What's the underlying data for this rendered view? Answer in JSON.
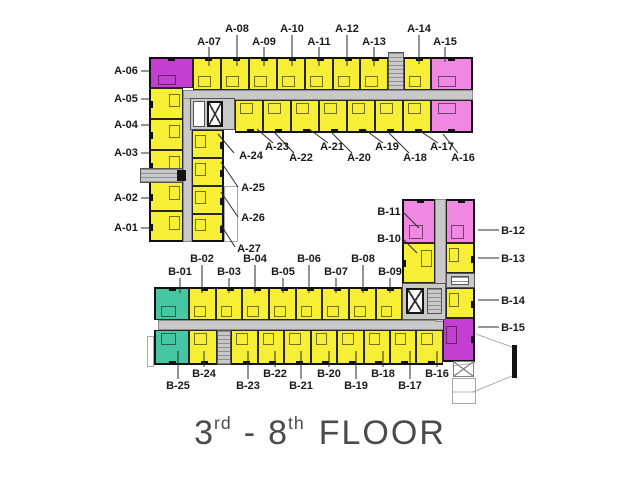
{
  "title": {
    "floor_start_num": "3",
    "floor_start_suffix": "rd",
    "separator": "-",
    "floor_end_num": "8",
    "floor_end_suffix": "th",
    "floor_word": "FLOOR"
  },
  "colors": {
    "unit_yellow": "#f7ef35",
    "unit_pink": "#ef87e3",
    "unit_magenta": "#c43fd1",
    "unit_teal": "#46c7a2",
    "corridor": "#c9c9c9",
    "label_text": "#1a1a1a",
    "title_text": "#4b4b4b"
  },
  "plan": {
    "rects": [
      {
        "n": "corridor-a-horizontal",
        "c": "corridor",
        "x": 183,
        "y": 90,
        "w": 290,
        "h": 10
      },
      {
        "n": "corridor-a-vertical",
        "c": "corridor",
        "x": 183,
        "y": 98,
        "w": 9,
        "h": 144
      },
      {
        "n": "corridor-b-horizontal",
        "c": "corridor",
        "x": 158,
        "y": 320,
        "w": 288,
        "h": 10
      },
      {
        "n": "corridor-b-vertical",
        "c": "corridor",
        "x": 435,
        "y": 199,
        "w": 11,
        "h": 123
      },
      {
        "n": "outline-b25-side",
        "c": "outline",
        "x": 147,
        "y": 336,
        "w": 7,
        "h": 31
      },
      {
        "n": "outline-a27-side",
        "c": "outline",
        "x": 224,
        "y": 186,
        "w": 14,
        "h": 56
      },
      {
        "n": "unit-A-06",
        "c": "unit magenta o-n e-n e-w",
        "x": 149,
        "y": 57,
        "w": 44,
        "h": 31
      },
      {
        "n": "unit-A-07",
        "c": "unit yellow o-n e-n",
        "x": 193,
        "y": 57,
        "w": 28,
        "h": 33
      },
      {
        "n": "unit-A-08",
        "c": "unit yellow o-n e-n",
        "x": 221,
        "y": 57,
        "w": 28,
        "h": 33
      },
      {
        "n": "unit-A-09",
        "c": "unit yellow o-n e-n",
        "x": 249,
        "y": 57,
        "w": 28,
        "h": 33
      },
      {
        "n": "unit-A-10",
        "c": "unit yellow o-n e-n",
        "x": 277,
        "y": 57,
        "w": 28,
        "h": 33
      },
      {
        "n": "unit-A-11",
        "c": "unit yellow o-n e-n",
        "x": 305,
        "y": 57,
        "w": 28,
        "h": 33
      },
      {
        "n": "unit-A-12",
        "c": "unit yellow o-n e-n",
        "x": 333,
        "y": 57,
        "w": 27,
        "h": 33
      },
      {
        "n": "unit-A-13",
        "c": "unit yellow o-n e-n",
        "x": 360,
        "y": 57,
        "w": 28,
        "h": 33
      },
      {
        "n": "unit-A-14",
        "c": "unit yellow o-n e-n",
        "x": 404,
        "y": 57,
        "w": 27,
        "h": 33
      },
      {
        "n": "unit-A-15",
        "c": "unit pink o-n e-n e-e",
        "x": 431,
        "y": 57,
        "w": 42,
        "h": 33
      },
      {
        "n": "unit-A-23",
        "c": "unit yellow o-s e-s",
        "x": 235,
        "y": 100,
        "w": 28,
        "h": 33
      },
      {
        "n": "unit-A-22",
        "c": "unit yellow o-s e-s",
        "x": 263,
        "y": 100,
        "w": 28,
        "h": 33
      },
      {
        "n": "unit-A-21",
        "c": "unit yellow o-s e-s",
        "x": 291,
        "y": 100,
        "w": 28,
        "h": 33
      },
      {
        "n": "unit-A-20",
        "c": "unit yellow o-s e-s",
        "x": 319,
        "y": 100,
        "w": 28,
        "h": 33
      },
      {
        "n": "unit-A-19",
        "c": "unit yellow o-s e-s",
        "x": 347,
        "y": 100,
        "w": 28,
        "h": 33
      },
      {
        "n": "unit-A-18",
        "c": "unit yellow o-s e-s",
        "x": 375,
        "y": 100,
        "w": 28,
        "h": 33
      },
      {
        "n": "unit-A-17",
        "c": "unit yellow o-s e-s",
        "x": 403,
        "y": 100,
        "w": 28,
        "h": 33
      },
      {
        "n": "unit-A-16",
        "c": "unit pink o-s e-s e-e",
        "x": 431,
        "y": 100,
        "w": 42,
        "h": 33
      },
      {
        "n": "unit-A-05",
        "c": "unit yellow o-w e-w",
        "x": 149,
        "y": 88,
        "w": 34,
        "h": 31
      },
      {
        "n": "unit-A-04",
        "c": "unit yellow o-w e-w",
        "x": 149,
        "y": 119,
        "w": 34,
        "h": 31
      },
      {
        "n": "unit-A-03",
        "c": "unit yellow o-w e-w",
        "x": 149,
        "y": 150,
        "w": 34,
        "h": 31
      },
      {
        "n": "unit-A-02",
        "c": "unit yellow o-w e-w",
        "x": 149,
        "y": 181,
        "w": 34,
        "h": 30
      },
      {
        "n": "unit-A-01",
        "c": "unit yellow o-w e-w e-s",
        "x": 149,
        "y": 211,
        "w": 34,
        "h": 31
      },
      {
        "n": "unit-A-24",
        "c": "unit yellow o-e e-e",
        "x": 192,
        "y": 130,
        "w": 32,
        "h": 28
      },
      {
        "n": "unit-A-25",
        "c": "unit yellow o-e e-e",
        "x": 192,
        "y": 158,
        "w": 32,
        "h": 28
      },
      {
        "n": "unit-A-26",
        "c": "unit yellow o-e e-e",
        "x": 192,
        "y": 186,
        "w": 32,
        "h": 28
      },
      {
        "n": "unit-A-27",
        "c": "unit yellow o-e e-e e-s",
        "x": 192,
        "y": 214,
        "w": 32,
        "h": 28
      },
      {
        "n": "unit-B-11",
        "c": "unit pink o-n e-n e-w",
        "x": 402,
        "y": 199,
        "w": 33,
        "h": 44
      },
      {
        "n": "unit-B-12",
        "c": "unit pink o-n e-n e-e",
        "x": 446,
        "y": 199,
        "w": 29,
        "h": 44
      },
      {
        "n": "unit-B-10",
        "c": "unit yellow o-w e-w",
        "x": 402,
        "y": 243,
        "w": 33,
        "h": 40
      },
      {
        "n": "unit-B-13",
        "c": "unit yellow o-e e-e",
        "x": 446,
        "y": 243,
        "w": 29,
        "h": 30
      },
      {
        "n": "unit-B-14",
        "c": "unit yellow o-e e-e",
        "x": 446,
        "y": 288,
        "w": 29,
        "h": 30
      },
      {
        "n": "unit-B-15",
        "c": "unit magenta o-e e-e e-s",
        "x": 443,
        "y": 318,
        "w": 32,
        "h": 44
      },
      {
        "n": "unit-B-01",
        "c": "unit teal o-n e-n e-w",
        "x": 154,
        "y": 287,
        "w": 35,
        "h": 33
      },
      {
        "n": "unit-B-02",
        "c": "unit yellow o-n e-n",
        "x": 189,
        "y": 287,
        "w": 27,
        "h": 33
      },
      {
        "n": "unit-B-03",
        "c": "unit yellow o-n e-n",
        "x": 216,
        "y": 287,
        "w": 26,
        "h": 33
      },
      {
        "n": "unit-B-04",
        "c": "unit yellow o-n e-n",
        "x": 242,
        "y": 287,
        "w": 27,
        "h": 33
      },
      {
        "n": "unit-B-05",
        "c": "unit yellow o-n e-n",
        "x": 269,
        "y": 287,
        "w": 27,
        "h": 33
      },
      {
        "n": "unit-B-06",
        "c": "unit yellow o-n e-n",
        "x": 296,
        "y": 287,
        "w": 26,
        "h": 33
      },
      {
        "n": "unit-B-07",
        "c": "unit yellow o-n e-n",
        "x": 322,
        "y": 287,
        "w": 27,
        "h": 33
      },
      {
        "n": "unit-B-08",
        "c": "unit yellow o-n e-n",
        "x": 349,
        "y": 287,
        "w": 27,
        "h": 33
      },
      {
        "n": "unit-B-09",
        "c": "unit yellow o-n e-n",
        "x": 376,
        "y": 287,
        "w": 26,
        "h": 33
      },
      {
        "n": "unit-B-25",
        "c": "unit teal o-s e-s e-w",
        "x": 154,
        "y": 330,
        "w": 35,
        "h": 35
      },
      {
        "n": "unit-B-24",
        "c": "unit yellow o-s e-s",
        "x": 189,
        "y": 330,
        "w": 28,
        "h": 35
      },
      {
        "n": "unit-B-23",
        "c": "unit yellow o-s e-s",
        "x": 231,
        "y": 330,
        "w": 27,
        "h": 35
      },
      {
        "n": "unit-B-22",
        "c": "unit yellow o-s e-s",
        "x": 258,
        "y": 330,
        "w": 26,
        "h": 35
      },
      {
        "n": "unit-B-21",
        "c": "unit yellow o-s e-s",
        "x": 284,
        "y": 330,
        "w": 27,
        "h": 35
      },
      {
        "n": "unit-B-20",
        "c": "unit yellow o-s e-s",
        "x": 311,
        "y": 330,
        "w": 26,
        "h": 35
      },
      {
        "n": "unit-B-19",
        "c": "unit yellow o-s e-s",
        "x": 337,
        "y": 330,
        "w": 27,
        "h": 35
      },
      {
        "n": "unit-B-18",
        "c": "unit yellow o-s e-s",
        "x": 364,
        "y": 330,
        "w": 26,
        "h": 35
      },
      {
        "n": "unit-B-17",
        "c": "unit yellow o-s e-s",
        "x": 390,
        "y": 330,
        "w": 26,
        "h": 35
      },
      {
        "n": "unit-B-16",
        "c": "unit yellow o-s e-s",
        "x": 416,
        "y": 330,
        "w": 27,
        "h": 35
      },
      {
        "n": "stair-core-a-top",
        "c": "core treads",
        "x": 388,
        "y": 52,
        "w": 16,
        "h": 38
      },
      {
        "n": "elevator-core-a",
        "c": "core",
        "x": 190,
        "y": 98,
        "w": 45,
        "h": 32
      },
      {
        "n": "elevator-lobby-a",
        "c": "whitebox",
        "x": 193,
        "y": 101,
        "w": 12,
        "h": 26
      },
      {
        "n": "elevator-shaft-a",
        "c": "xbox",
        "x": 207,
        "y": 101,
        "w": 16,
        "h": 26
      },
      {
        "n": "service-core-b",
        "c": "core",
        "x": 402,
        "y": 283,
        "w": 44,
        "h": 37
      },
      {
        "n": "elevator-shaft-b",
        "c": "xbox",
        "x": 406,
        "y": 288,
        "w": 18,
        "h": 26
      },
      {
        "n": "stair-shaft-b",
        "c": "core treads",
        "x": 427,
        "y": 288,
        "w": 15,
        "h": 26
      },
      {
        "n": "stair-core-b-bottom",
        "c": "core treads",
        "x": 217,
        "y": 330,
        "w": 14,
        "h": 35
      },
      {
        "n": "vent-strip-b",
        "c": "core",
        "x": 446,
        "y": 273,
        "w": 29,
        "h": 15
      },
      {
        "n": "vent-box-b",
        "c": "whitebox treads",
        "x": 451,
        "y": 276,
        "w": 18,
        "h": 9
      },
      {
        "n": "entry-bridge-a",
        "c": "core treads",
        "x": 140,
        "y": 168,
        "w": 43,
        "h": 15
      },
      {
        "n": "entry-bridge-post",
        "c": "blackbox",
        "x": 177,
        "y": 170,
        "w": 9,
        "h": 11
      },
      {
        "n": "ramp-box-x",
        "c": "lightx",
        "x": 453,
        "y": 361,
        "w": 21,
        "h": 16
      },
      {
        "n": "ramp-outline",
        "c": "outline",
        "x": 452,
        "y": 378,
        "w": 24,
        "h": 26
      },
      {
        "n": "section-marker-bar",
        "c": "blackbox",
        "x": 512,
        "y": 345,
        "w": 5,
        "h": 33
      }
    ],
    "tags": [
      {
        "t": "A-08",
        "x": 237,
        "y": 23
      },
      {
        "t": "A-10",
        "x": 292,
        "y": 23
      },
      {
        "t": "A-12",
        "x": 347,
        "y": 23
      },
      {
        "t": "A-14",
        "x": 419,
        "y": 23
      },
      {
        "t": "A-07",
        "x": 209,
        "y": 36
      },
      {
        "t": "A-09",
        "x": 264,
        "y": 36
      },
      {
        "t": "A-11",
        "x": 319,
        "y": 36
      },
      {
        "t": "A-13",
        "x": 374,
        "y": 36
      },
      {
        "t": "A-15",
        "x": 445,
        "y": 36
      },
      {
        "t": "A-06",
        "x": 126,
        "y": 65
      },
      {
        "t": "A-05",
        "x": 126,
        "y": 93
      },
      {
        "t": "A-04",
        "x": 126,
        "y": 119
      },
      {
        "t": "A-03",
        "x": 126,
        "y": 147
      },
      {
        "t": "A-02",
        "x": 126,
        "y": 192
      },
      {
        "t": "A-01",
        "x": 126,
        "y": 222
      },
      {
        "t": "A-24",
        "x": 251,
        "y": 150
      },
      {
        "t": "A-25",
        "x": 253,
        "y": 182
      },
      {
        "t": "A-26",
        "x": 253,
        "y": 212
      },
      {
        "t": "A-27",
        "x": 249,
        "y": 243
      },
      {
        "t": "A-23",
        "x": 277,
        "y": 141
      },
      {
        "t": "A-21",
        "x": 332,
        "y": 141
      },
      {
        "t": "A-19",
        "x": 387,
        "y": 141
      },
      {
        "t": "A-17",
        "x": 442,
        "y": 141
      },
      {
        "t": "A-22",
        "x": 301,
        "y": 152
      },
      {
        "t": "A-20",
        "x": 359,
        "y": 152
      },
      {
        "t": "A-18",
        "x": 415,
        "y": 152
      },
      {
        "t": "A-16",
        "x": 463,
        "y": 152
      },
      {
        "t": "B-11",
        "x": 389,
        "y": 206
      },
      {
        "t": "B-10",
        "x": 389,
        "y": 233
      },
      {
        "t": "B-12",
        "x": 513,
        "y": 225
      },
      {
        "t": "B-13",
        "x": 513,
        "y": 253
      },
      {
        "t": "B-14",
        "x": 513,
        "y": 295
      },
      {
        "t": "B-15",
        "x": 513,
        "y": 322
      },
      {
        "t": "B-02",
        "x": 202,
        "y": 253
      },
      {
        "t": "B-04",
        "x": 255,
        "y": 253
      },
      {
        "t": "B-06",
        "x": 309,
        "y": 253
      },
      {
        "t": "B-08",
        "x": 363,
        "y": 253
      },
      {
        "t": "B-01",
        "x": 180,
        "y": 266
      },
      {
        "t": "B-03",
        "x": 229,
        "y": 266
      },
      {
        "t": "B-05",
        "x": 283,
        "y": 266
      },
      {
        "t": "B-07",
        "x": 336,
        "y": 266
      },
      {
        "t": "B-09",
        "x": 390,
        "y": 266
      },
      {
        "t": "B-24",
        "x": 204,
        "y": 368
      },
      {
        "t": "B-22",
        "x": 275,
        "y": 368
      },
      {
        "t": "B-20",
        "x": 329,
        "y": 368
      },
      {
        "t": "B-18",
        "x": 383,
        "y": 368
      },
      {
        "t": "B-16",
        "x": 437,
        "y": 368
      },
      {
        "t": "B-25",
        "x": 178,
        "y": 380
      },
      {
        "t": "B-23",
        "x": 248,
        "y": 380
      },
      {
        "t": "B-21",
        "x": 301,
        "y": 380
      },
      {
        "t": "B-19",
        "x": 356,
        "y": 380
      },
      {
        "t": "B-17",
        "x": 410,
        "y": 380
      }
    ],
    "lines": [
      [
        237,
        35,
        237,
        66
      ],
      [
        292,
        35,
        292,
        66
      ],
      [
        347,
        35,
        347,
        66
      ],
      [
        419,
        35,
        419,
        64
      ],
      [
        209,
        47,
        209,
        66
      ],
      [
        264,
        47,
        264,
        66
      ],
      [
        319,
        47,
        319,
        66
      ],
      [
        374,
        47,
        374,
        66
      ],
      [
        445,
        47,
        445,
        62
      ],
      [
        141,
        71,
        151,
        71
      ],
      [
        141,
        99,
        151,
        99
      ],
      [
        141,
        125,
        151,
        125
      ],
      [
        141,
        153,
        151,
        153
      ],
      [
        141,
        198,
        151,
        198
      ],
      [
        141,
        228,
        151,
        228
      ],
      [
        234,
        153,
        218,
        134
      ],
      [
        238,
        187,
        221,
        162
      ],
      [
        238,
        217,
        221,
        192
      ],
      [
        235,
        247,
        221,
        225
      ],
      [
        273,
        143,
        257,
        129
      ],
      [
        294,
        153,
        274,
        132
      ],
      [
        328,
        143,
        309,
        129
      ],
      [
        352,
        153,
        331,
        132
      ],
      [
        383,
        143,
        364,
        129
      ],
      [
        409,
        153,
        388,
        132
      ],
      [
        438,
        143,
        417,
        129
      ],
      [
        458,
        153,
        443,
        134
      ],
      [
        403,
        212,
        419,
        228
      ],
      [
        403,
        239,
        417,
        253
      ],
      [
        478,
        230,
        499,
        230
      ],
      [
        478,
        258,
        499,
        258
      ],
      [
        478,
        300,
        499,
        300
      ],
      [
        478,
        327,
        499,
        327
      ],
      [
        202,
        265,
        202,
        293
      ],
      [
        255,
        265,
        255,
        293
      ],
      [
        309,
        265,
        309,
        293
      ],
      [
        363,
        265,
        363,
        293
      ],
      [
        180,
        278,
        180,
        293
      ],
      [
        229,
        278,
        229,
        293
      ],
      [
        283,
        278,
        283,
        293
      ],
      [
        336,
        278,
        336,
        293
      ],
      [
        390,
        278,
        390,
        293
      ],
      [
        204,
        367,
        204,
        351
      ],
      [
        275,
        367,
        275,
        351
      ],
      [
        329,
        367,
        329,
        351
      ],
      [
        383,
        367,
        383,
        351
      ],
      [
        437,
        367,
        437,
        351
      ],
      [
        178,
        379,
        178,
        351
      ],
      [
        248,
        379,
        248,
        351
      ],
      [
        301,
        379,
        301,
        351
      ],
      [
        356,
        379,
        356,
        351
      ],
      [
        410,
        379,
        410,
        351
      ]
    ],
    "thin_lines": [
      [
        476,
        334,
        512,
        347
      ],
      [
        473,
        392,
        512,
        376
      ],
      [
        452,
        366,
        475,
        363
      ],
      [
        452,
        392,
        475,
        392
      ]
    ]
  }
}
